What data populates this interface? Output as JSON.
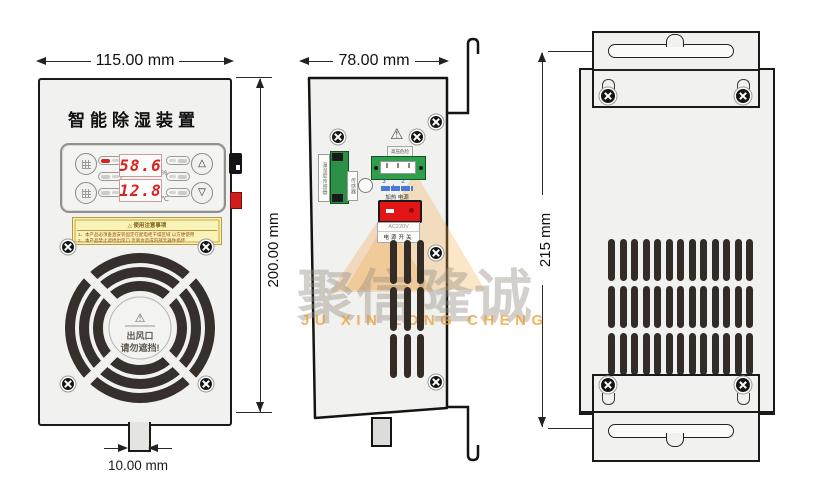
{
  "front": {
    "title": "智能除湿装置",
    "display": {
      "humidity_value": "58.6",
      "humidity_unit": "%",
      "temp_value": "12.8",
      "temp_unit": "℃"
    },
    "buttons": {
      "up_glyph": "△",
      "down_glyph": "▽"
    },
    "caution": {
      "heading": "△ 使用注意事项",
      "line1": "1、本产品必须垂直安装固定在配电柜干燥区域 以方便使用",
      "line2": "2、本产品禁止遮挡出风口 否则会造成内部元器件损坏"
    },
    "fan": {
      "warning_icon": "⚠",
      "line1": "出风口",
      "line2": "请勿遮挡!"
    },
    "dim_top": "115.00 mm",
    "dim_right": "200.00 mm",
    "dim_bottom": "10.00 mm"
  },
  "side": {
    "dim_top": "78.00 mm",
    "hazard_icon": "⚠",
    "hazard_label": "高压危险",
    "sensor_label": "温湿度传感器",
    "sensor_label2": "传感器",
    "terminal_numbers": "3 2 1",
    "terminal_names": "加热 电源",
    "voltage": "AC220V",
    "power_switch": "电源开关"
  },
  "back": {
    "dim_left": "215 mm"
  },
  "watermark": {
    "cn": "聚信隆诚",
    "en": "JU XIN LONG CHENG"
  }
}
